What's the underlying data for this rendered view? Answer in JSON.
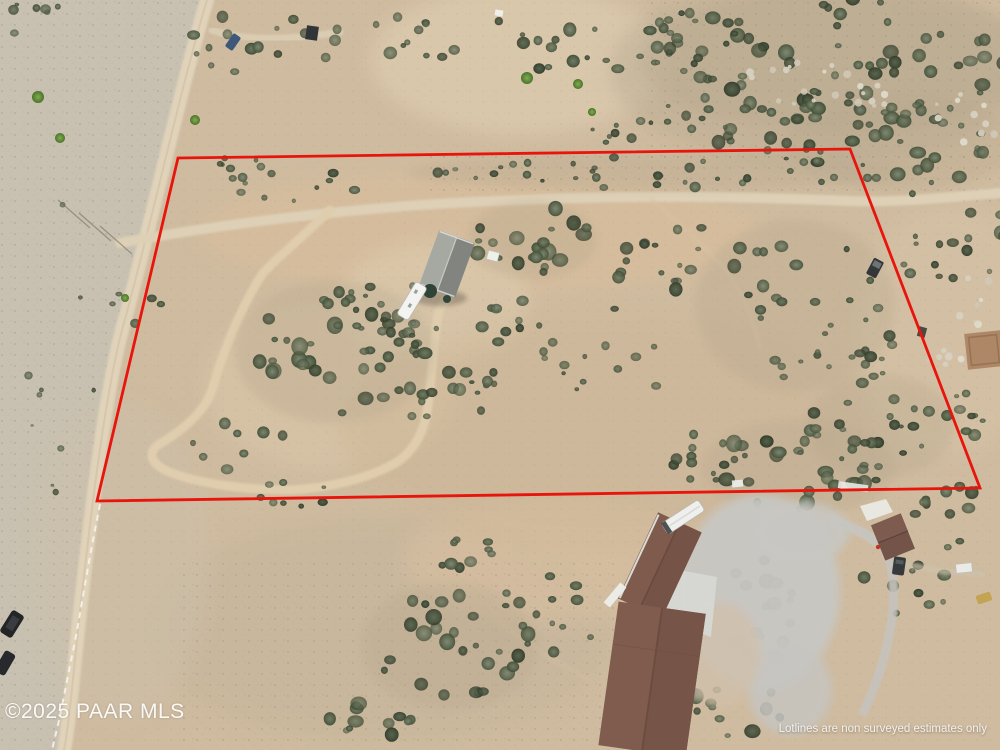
{
  "photo": {
    "kind": "aerial-drone-photo",
    "copyright": "©2025 PAAR MLS",
    "disclaimer": "Lotlines are non surveyed estimates only"
  },
  "boundary": {
    "color": "#e8150d",
    "points": "178,158 850,149 980,488 97,501"
  }
}
